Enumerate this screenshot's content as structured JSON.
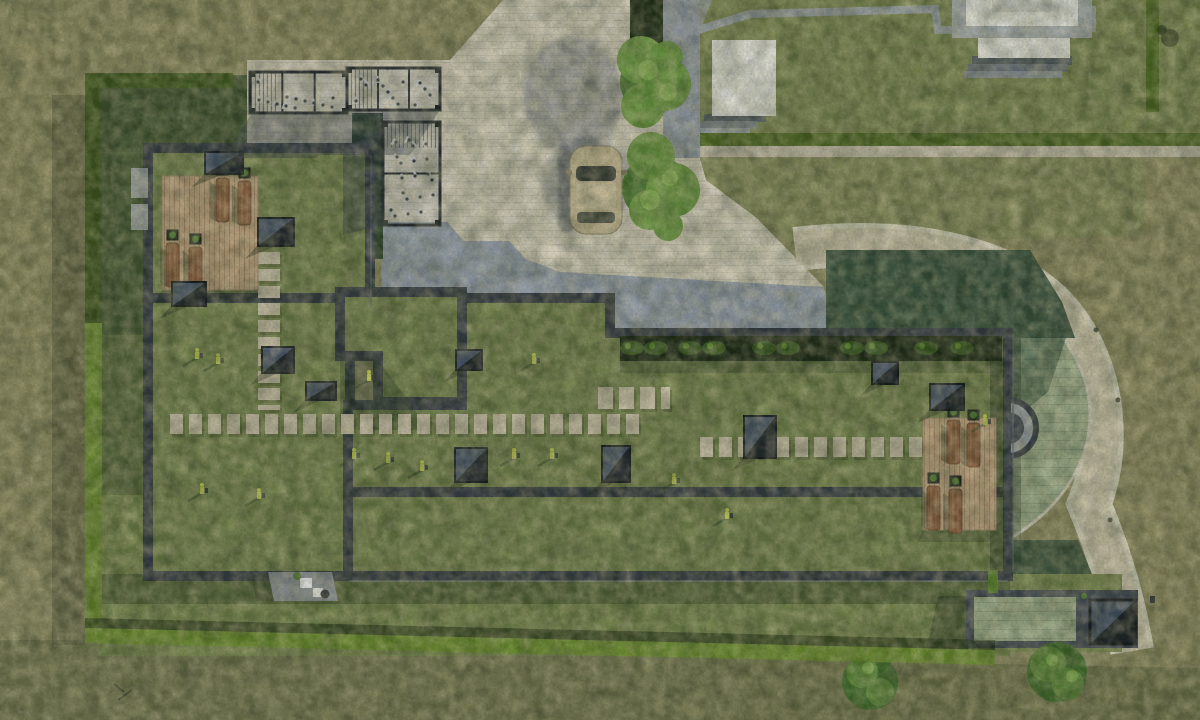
{
  "scene_type": "aerial-architectural-render",
  "palette": {
    "field": "#8f8c63",
    "field_dark": "#73764e",
    "lawn": "#77884f",
    "lawn_shadow": "#2e4630",
    "roof_grass": "#74844e",
    "parapet": "#343b46",
    "plaza": "#ded7c7",
    "plaza_shadow": "#97a1b5",
    "sidewalk": "#99a1ae",
    "road": "#d6cdb7",
    "kerb": "#e9e3d3",
    "pavers_green": "#a3b393",
    "pavers_green_shadow": "#2c4837",
    "hedge": "#6a8c2f",
    "hedge_dark": "#1f2d19",
    "deck": "#c3a583",
    "lounger": "#8f5f41",
    "white_structure": "#f2f1ed",
    "gray_structure": "#9aa2a8",
    "neighbor_grass": "#7b8752",
    "tree": "#6f9d45",
    "tree_dark": "#4b7a33",
    "car_body": "#cabb98",
    "car_glass": "#3c403c",
    "equipment_accent": "#c8d352",
    "stone": "#cdc4ae",
    "skylight_dark": "#20262f",
    "skylight_light": "#4a5770"
  },
  "scene": {
    "objects": {
      "main_building": "L-shaped complex with extensive green roof and dark parapets",
      "neighbor_building": "green-roof building, top right",
      "outbuilding": "garage entry pavilion, bottom right",
      "car": "beige hatchback parked on plaza",
      "bike_shelters": 3,
      "trees": 2,
      "shrubs": 2,
      "timber_decks": 2,
      "sun_loungers": 8,
      "skylights": 11,
      "fitness_stations": 14,
      "stepping_stone_paths": 4
    },
    "skylights": [
      [
        205,
        152,
        38,
        22
      ],
      [
        258,
        218,
        36,
        28
      ],
      [
        172,
        282,
        34,
        24
      ],
      [
        262,
        347,
        32,
        26
      ],
      [
        306,
        382,
        30,
        18
      ],
      [
        456,
        350,
        26,
        20
      ],
      [
        455,
        448,
        32,
        34
      ],
      [
        602,
        446,
        28,
        36
      ],
      [
        744,
        416,
        32,
        42
      ],
      [
        872,
        362,
        26,
        22
      ],
      [
        930,
        384,
        34,
        26
      ]
    ],
    "fitness": [
      [
        195,
        352
      ],
      [
        216,
        357
      ],
      [
        532,
        357
      ],
      [
        352,
        452
      ],
      [
        386,
        456
      ],
      [
        420,
        464
      ],
      [
        512,
        452
      ],
      [
        550,
        452
      ],
      [
        200,
        487
      ],
      [
        257,
        492
      ],
      [
        672,
        477
      ],
      [
        725,
        512
      ],
      [
        367,
        374
      ],
      [
        983,
        418
      ]
    ],
    "loungers": [
      [
        216,
        178
      ],
      [
        238,
        181
      ],
      [
        166,
        243
      ],
      [
        189,
        247
      ],
      [
        947,
        420
      ],
      [
        967,
        423
      ],
      [
        927,
        486
      ],
      [
        949,
        489
      ]
    ],
    "stone_paths": [
      {
        "x1": 269,
        "y1": 252,
        "x2": 269,
        "y2": 410,
        "w": 22,
        "dash": "12 5"
      },
      {
        "x1": 170,
        "y1": 424,
        "x2": 640,
        "y2": 424,
        "w": 20,
        "dash": "13 6"
      },
      {
        "x1": 598,
        "y1": 398,
        "x2": 670,
        "y2": 398,
        "w": 22,
        "dash": "15 6"
      },
      {
        "x1": 700,
        "y1": 447,
        "x2": 928,
        "y2": 447,
        "w": 20,
        "dash": "13 6"
      }
    ],
    "shelters": [
      {
        "x": 250,
        "y": 72,
        "w": 97,
        "h": 41
      },
      {
        "x": 347,
        "y": 68,
        "w": 93,
        "h": 42
      },
      {
        "x": 383,
        "y": 122,
        "w": 57,
        "h": 103
      }
    ],
    "hedge_clumps_x": [
      632,
      656,
      690,
      714,
      764,
      788,
      852,
      876,
      926,
      962
    ],
    "road_bollards": [
      [
        1042,
        276
      ],
      [
        1096,
        330
      ],
      [
        1118,
        400
      ],
      [
        1110,
        520
      ]
    ]
  }
}
